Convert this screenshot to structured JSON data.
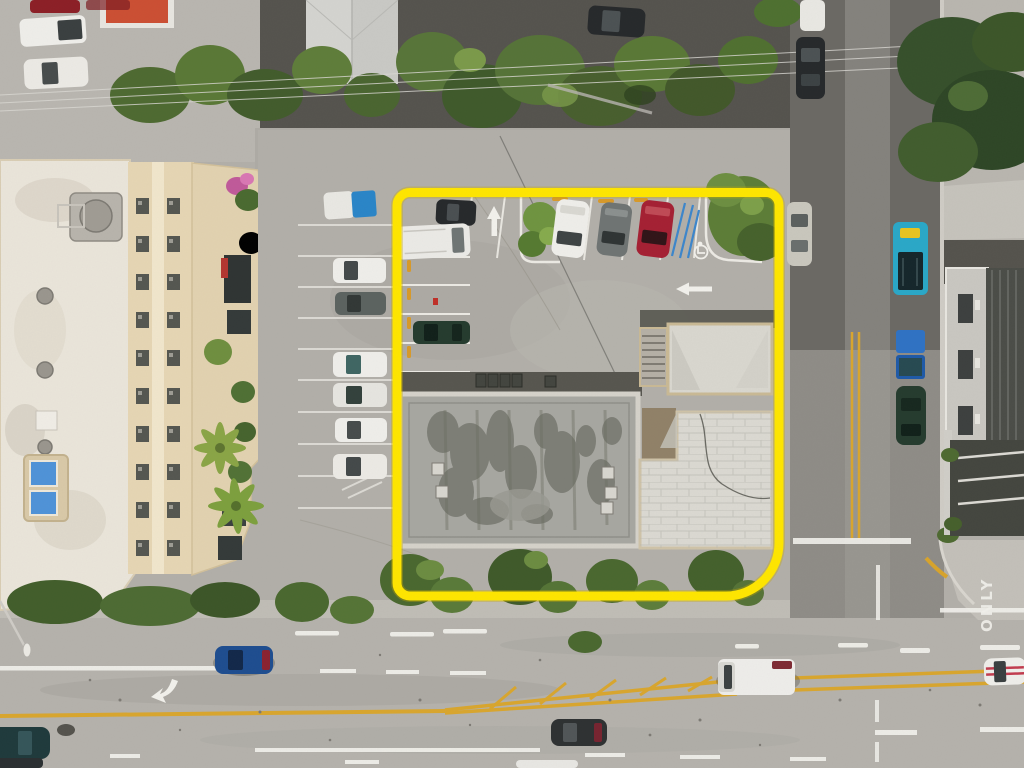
{
  "scene": {
    "type": "aerial-drone-photograph",
    "subject": "commercial corner property outlined in yellow with parking lot, flat-roof building, adjacent apartment building and two intersecting streets",
    "road_label": "ONLY"
  },
  "colors": {
    "property_outline": "#ffe600",
    "outline_shadow": "#c9a900",
    "asphalt_light": "#b4b1ab",
    "asphalt_dark": "#57564f",
    "concrete_sidewalk": "#c2bfb8",
    "roof_left_gray": "#a7a7a1",
    "roof_right_white": "#dbd9d2",
    "roof_stain": "#5c5e54",
    "apartment_roof_white": "#eae5da",
    "apartment_wall_beige": "#e6d6b4",
    "vegetation_green": "#4e6a31",
    "vegetation_dark": "#36502b",
    "palm_green": "#8aa546",
    "marking_white": "#f2f1ec",
    "road_yellow": "#d9a62e",
    "wheel_stop_yellow": "#d89a2a",
    "handicap_blue": "#3c86cc",
    "pool_blue": "#4f93d8",
    "car_white": "#efeeea",
    "car_red": "#a52033",
    "car_gray": "#6f7473",
    "car_black": "#26292b",
    "car_blue": "#1e4d90",
    "car_dark_green": "#253b2e",
    "taxi_teal": "#2aa8c8",
    "dumpster_blue": "#2f72c4",
    "sports_stripe_red": "#c23b4e",
    "red_roof": "#cc4f33"
  }
}
